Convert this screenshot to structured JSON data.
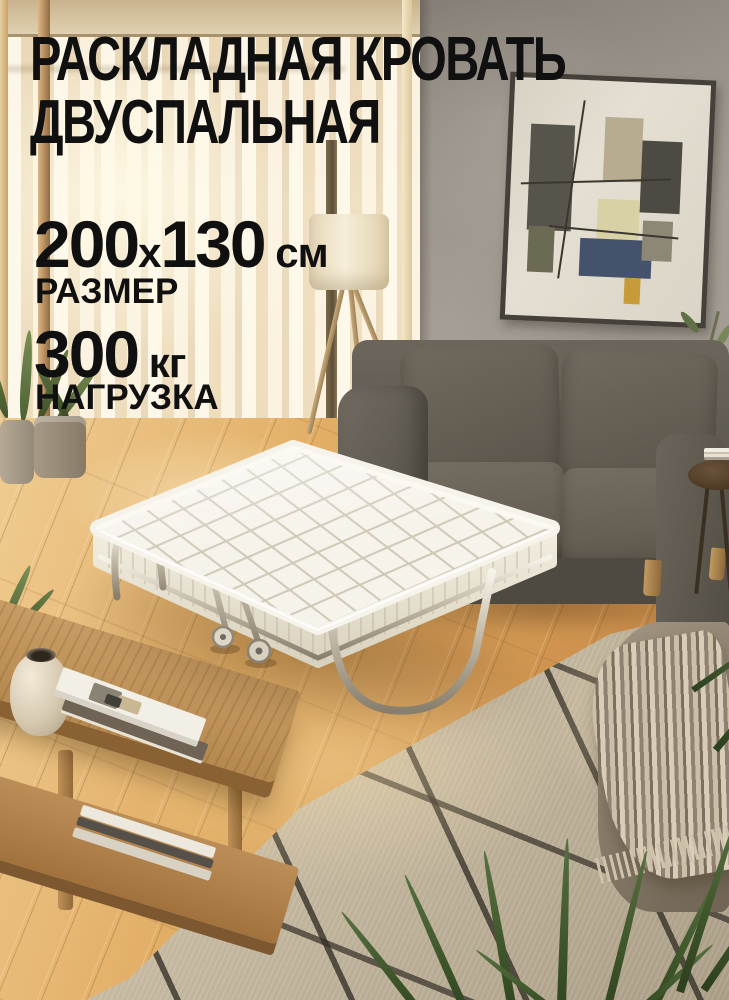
{
  "meta": {
    "type": "marketplace-product-banner",
    "language": "ru",
    "subject": "folding double bed in living room"
  },
  "overlay": {
    "title_line1": "РАСКЛАДНАЯ КРОВАТЬ",
    "title_line2": "ДВУСПАЛЬНАЯ",
    "size": {
      "value1": "200",
      "separator": "х",
      "value2": "130",
      "unit": " см",
      "label": "РАЗМЕР"
    },
    "load": {
      "value": "300",
      "unit": " кг",
      "label": "НАГРУЗКА"
    },
    "text_color": "#101010"
  },
  "palette": {
    "wall": "#9d968c",
    "curtain": "#f3e6ca",
    "floor_wood": "#d9a25c",
    "rug": "#c6b9a1",
    "rug_lines": "#3b352c",
    "sofa": "#5f594f",
    "mattress": "#f6f3ea",
    "chrome": "#c9c1af",
    "table_wood": "#b5894f",
    "lamp_shade": "#f0e6cf",
    "plant_green": "#3c5329",
    "painting_navy": "#45526b",
    "painting_olive": "#57544b",
    "painting_tan": "#b7ac90",
    "painting_yellow": "#d8d1a6"
  }
}
